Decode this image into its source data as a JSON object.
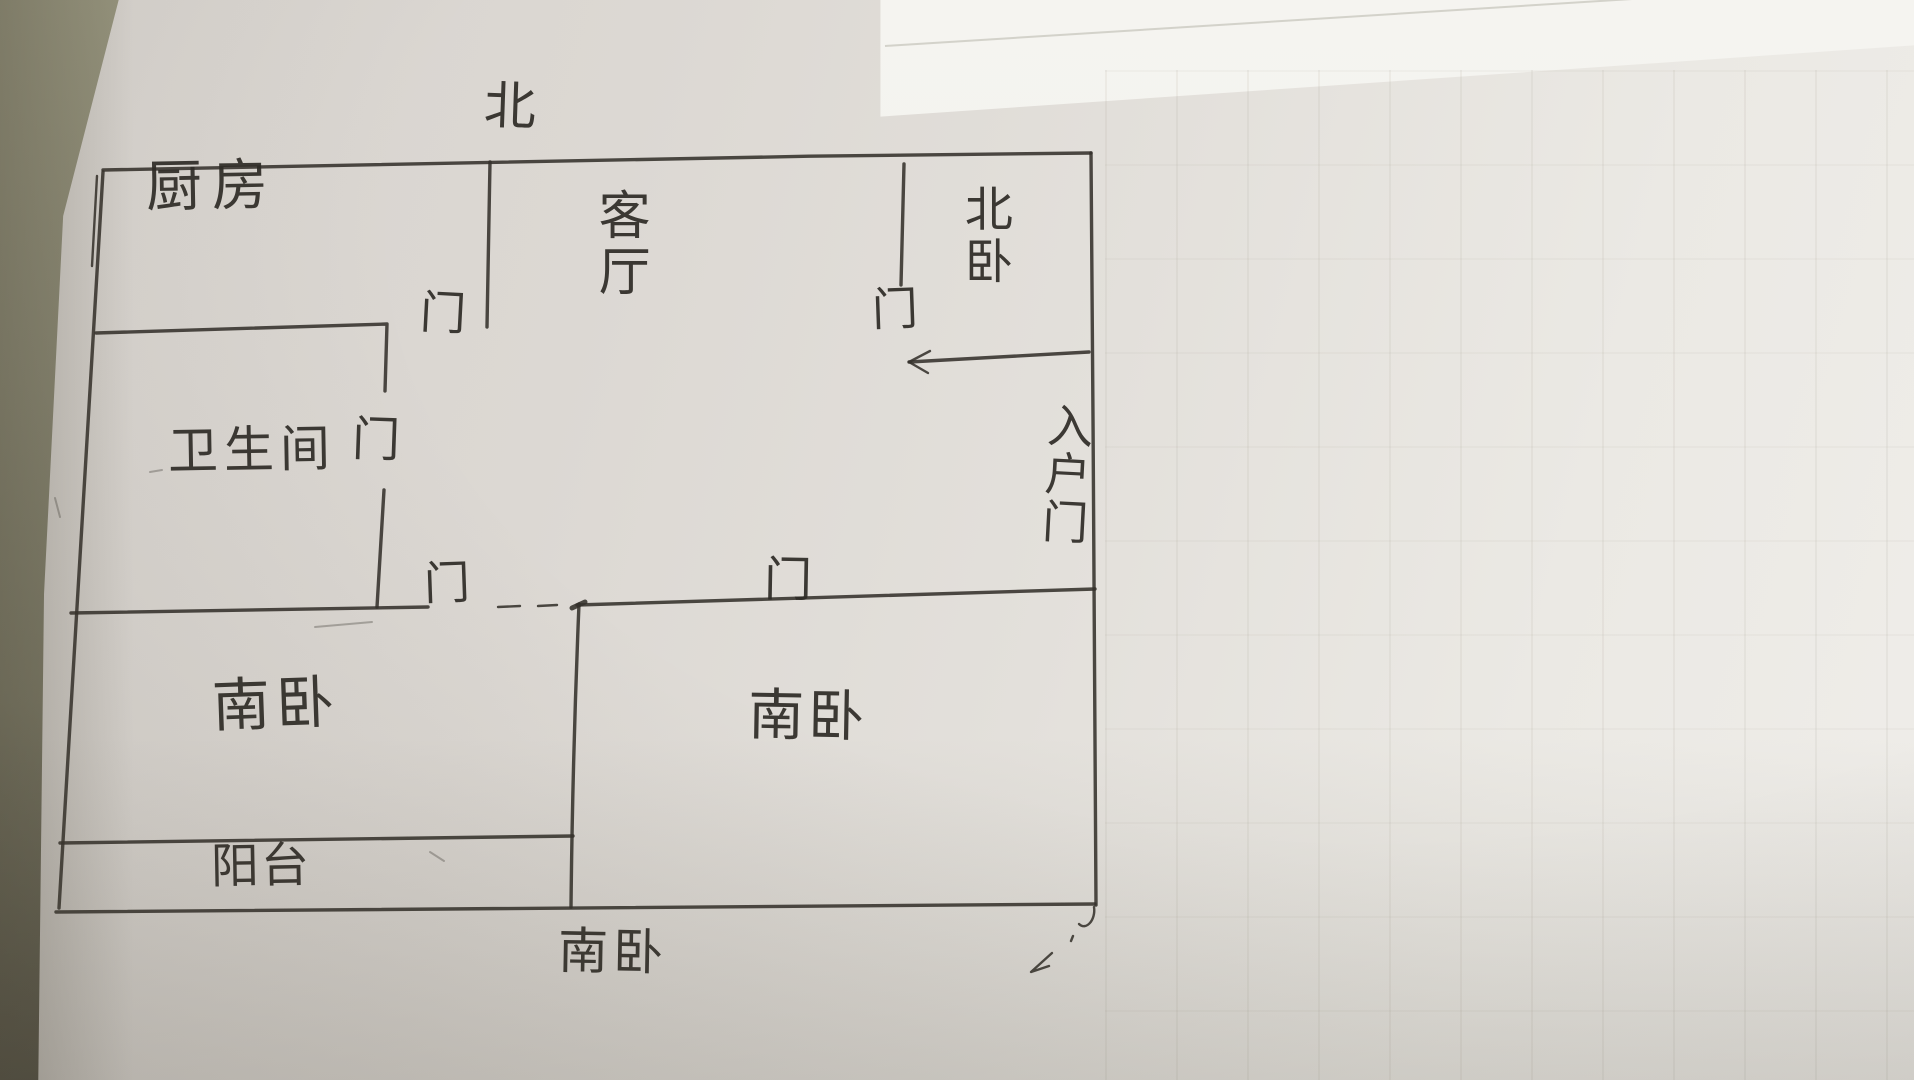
{
  "document": {
    "kind": "hand-drawn apartment floor plan",
    "medium": "pen sketch on paper (photograph)"
  },
  "compass": {
    "top_label": "北",
    "bottom_label": "南卧"
  },
  "rooms": {
    "kitchen": "厨房",
    "living_room": "客厅",
    "north_bedroom": "北卧",
    "bathroom": "卫生间",
    "south_bedroom_left": "南卧",
    "south_bedroom_right": "南卧",
    "balcony": "阳台"
  },
  "doors": {
    "kitchen_door": "门",
    "north_bedroom_door": "门",
    "bathroom_door": "门",
    "south_bedroom_left_door": "门",
    "south_bedroom_right_door": "门",
    "entry_door": "入户门"
  },
  "colors": {
    "ink": "#34312b",
    "paper_light": "#efede9",
    "paper_mid": "#dcd8d3",
    "table_edge": "#8b8974"
  }
}
